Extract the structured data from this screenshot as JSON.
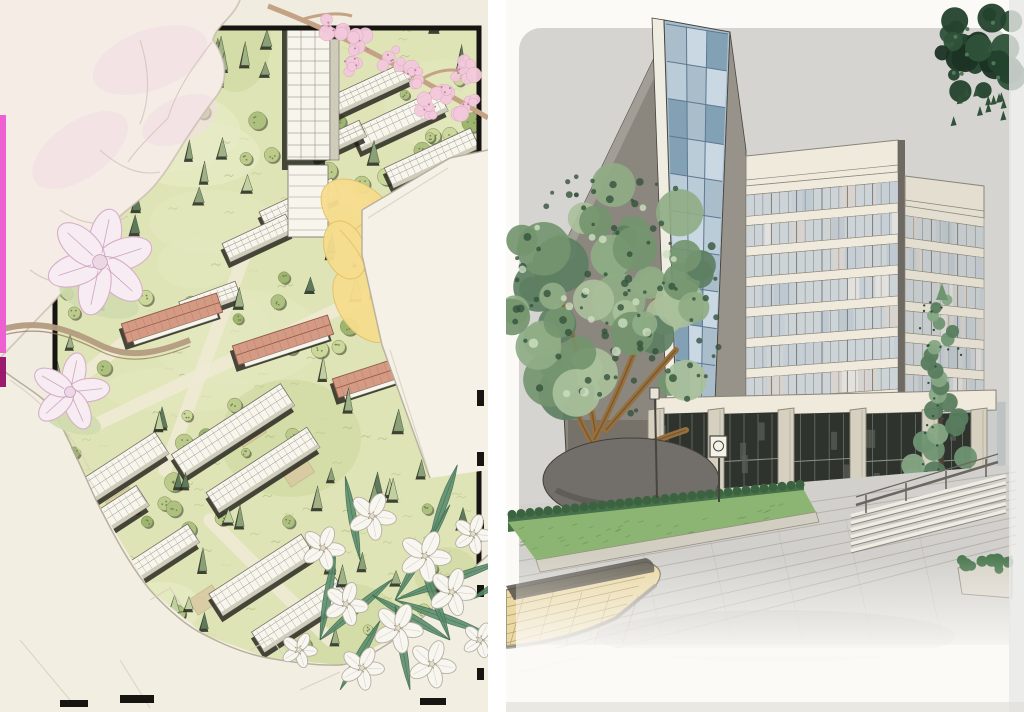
{
  "page": {
    "title": "photo of two hand-drawn architectural renderings, side by side",
    "background": "#ffffff",
    "divider_color": "#ffffff"
  },
  "left_panel": {
    "name": "aerial-site-plan-drawing",
    "description": "hand-drawn bird's-eye site plan of a densely planted campus: white axonometric buildings and a small tower among conifer and canopy trees, three red-roofed halls on the central axis, black plan frame, decorated with magnolia blooms, a cherry-blossom branch, yellow petals, white oleander flowers and trompe-l'oeil torn paper edges",
    "palette": {
      "paper": "#f1ece0",
      "plan_green": "#dfe4b6",
      "plan_green_light": "#e9edc9",
      "plan_green_dark": "#cbd69c",
      "path_cream": "#f0ebd4",
      "conifer_dark": "#5e7a5a",
      "conifer_mid": "#8ba076",
      "conifer_light": "#c2cf9f",
      "canopy_green": "#bcca8c",
      "tree_shadow": "#22261c",
      "building_white": "#f7f5ec",
      "building_line": "#6f6f66",
      "building_side": "#cfccbb",
      "building_shadow": "#1d1d17",
      "red_roof": "#d59a84",
      "red_roof_line": "#8d5a49",
      "courtyard_tan": "#d9c9a0",
      "frame_black": "#171512",
      "blossom_pink": "#f3c9db",
      "blossom_deep": "#b97fa0",
      "magnolia_white": "#f6ecf2",
      "magnolia_line": "#d8aec9",
      "petal_cream": "#f4ece5",
      "petal_line": "#d6c3bd",
      "petal_blush": "#f2dde4",
      "yellow_petal": "#f7dd8e",
      "yellow_line": "#e2c06a",
      "flower_white": "#f8f6f0",
      "flower_line": "#b7b0a2",
      "leaf_green": "#5d8f6e",
      "branch_tan": "#c3a384",
      "pencil": "#b2a999",
      "pencil_light": "#d8d0c0",
      "marker_pink": "#ee60d2",
      "marker_magenta": "#9c1a6e"
    },
    "counts": {
      "conifers": 110,
      "canopy_trees": 75,
      "white_buildings": 14,
      "red_roof_buildings": 3,
      "white_flowers": 11,
      "blossom_clusters": 9,
      "magnolia_blooms": 2
    }
  },
  "right_panel": {
    "name": "building-perspective-drawing",
    "description": "marker-and-ink perspective rendering of a mid-rise office block: blue glass stair tower on the left, cream gridded curtain-wall facades, tall glazed colonnade base, lawn and clipped hedge, paved plaza with steps and railings, a large leafy tree at left, a young conifer at right, tan paving in the left foreground and a sprig of dark leaves at the top right corner",
    "palette": {
      "paper": "#fbfaf7",
      "sky_wash": "#d6d4d1",
      "plaza_wash": "#d2d0cc",
      "joint_line": "#b0aca6",
      "concrete_wall": "#8b867e",
      "concrete_dark": "#6e6a63",
      "glass_blue": "#a9bdcb",
      "glass_light": "#cfdde6",
      "glass_deep": "#7b9cb2",
      "glass_mullion": "#5d7890",
      "facade_cream": "#efeadb",
      "facade_line": "#8a857a",
      "window_base": "#cdd4d8",
      "base_glazing": "#2f332e",
      "base_mullion": "#6a7266",
      "pylon": "#d6d0c1",
      "pylon_line": "#8d8679",
      "tree_green": "#74956f",
      "tree_light": "#a9c09b",
      "tree_dark": "#33523c",
      "trunk_brown": "#96713f",
      "conifer_green": "#6f9472",
      "lawn": "#8cb573",
      "hedge": "#47714a",
      "boulder": "#726e69",
      "paving_tan": "#ead8a5",
      "paving_tan_line": "#b09a67",
      "curb_dark": "#55514a",
      "step_line": "#8e8a82",
      "ink": "#47443e",
      "corner_leaf_dark": "#24422e",
      "city_backdrop": "#c2c6c9"
    },
    "floors_front_tower": 8,
    "floors_right_tower": 7
  }
}
